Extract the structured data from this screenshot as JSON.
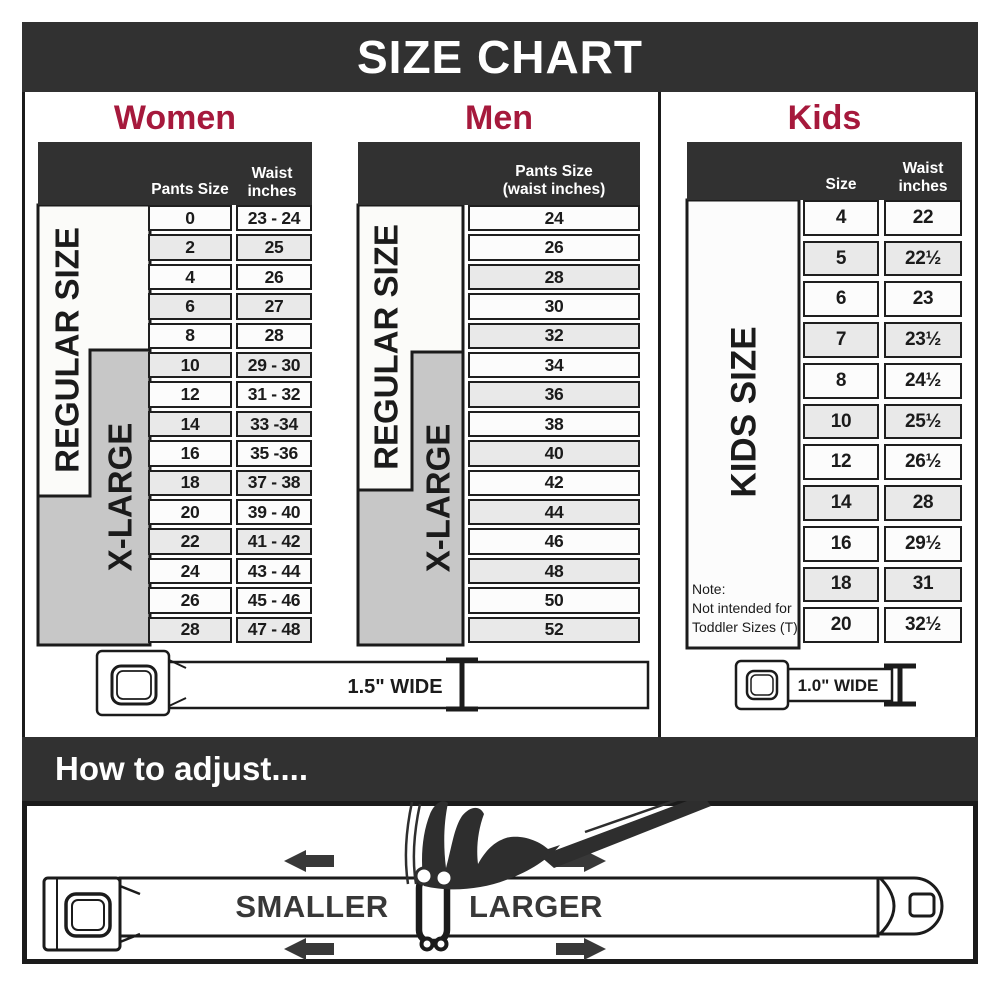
{
  "title": "SIZE CHART",
  "colors": {
    "accent_red": "#A6193C",
    "charcoal": "#313131",
    "row_shade": "#E9E9E9",
    "xlarge_gray": "#C7C7C7"
  },
  "sections": {
    "women": {
      "label": "Women",
      "col1": "Pants Size",
      "col2_line1": "Waist",
      "col2_line2": "inches",
      "regular_label": "REGULAR SIZE",
      "xlarge_label": "X-LARGE",
      "rows": [
        {
          "size": "0",
          "waist": "23 - 24",
          "shaded": false
        },
        {
          "size": "2",
          "waist": "25",
          "shaded": true
        },
        {
          "size": "4",
          "waist": "26",
          "shaded": false
        },
        {
          "size": "6",
          "waist": "27",
          "shaded": true
        },
        {
          "size": "8",
          "waist": "28",
          "shaded": false
        },
        {
          "size": "10",
          "waist": "29 - 30",
          "shaded": true
        },
        {
          "size": "12",
          "waist": "31 - 32",
          "shaded": false
        },
        {
          "size": "14",
          "waist": "33 -34",
          "shaded": true
        },
        {
          "size": "16",
          "waist": "35 -36",
          "shaded": false
        },
        {
          "size": "18",
          "waist": "37 - 38",
          "shaded": true
        },
        {
          "size": "20",
          "waist": "39 - 40",
          "shaded": false
        },
        {
          "size": "22",
          "waist": "41 - 42",
          "shaded": true
        },
        {
          "size": "24",
          "waist": "43 - 44",
          "shaded": false
        },
        {
          "size": "26",
          "waist": "45 - 46",
          "shaded": false
        },
        {
          "size": "28",
          "waist": "47 - 48",
          "shaded": true
        }
      ]
    },
    "men": {
      "label": "Men",
      "col1_line1": "Pants Size",
      "col1_line2": "(waist inches)",
      "regular_label": "REGULAR SIZE",
      "xlarge_label": "X-LARGE",
      "rows": [
        {
          "size": "24",
          "shaded": false
        },
        {
          "size": "26",
          "shaded": false
        },
        {
          "size": "28",
          "shaded": true
        },
        {
          "size": "30",
          "shaded": false
        },
        {
          "size": "32",
          "shaded": true
        },
        {
          "size": "34",
          "shaded": false
        },
        {
          "size": "36",
          "shaded": true
        },
        {
          "size": "38",
          "shaded": false
        },
        {
          "size": "40",
          "shaded": true
        },
        {
          "size": "42",
          "shaded": false
        },
        {
          "size": "44",
          "shaded": true
        },
        {
          "size": "46",
          "shaded": false
        },
        {
          "size": "48",
          "shaded": true
        },
        {
          "size": "50",
          "shaded": false
        },
        {
          "size": "52",
          "shaded": true
        }
      ]
    },
    "kids": {
      "label": "Kids",
      "col1": "Size",
      "col2_line1": "Waist",
      "col2_line2": "inches",
      "side_label": "KIDS SIZE",
      "note_line1": "Note:",
      "note_line2": "Not intended for",
      "note_line3": "Toddler Sizes (T)",
      "rows": [
        {
          "size": "4",
          "waist": "22",
          "shaded": false
        },
        {
          "size": "5",
          "waist": "22½",
          "shaded": true
        },
        {
          "size": "6",
          "waist": "23",
          "shaded": false
        },
        {
          "size": "7",
          "waist": "23½",
          "shaded": true
        },
        {
          "size": "8",
          "waist": "24½",
          "shaded": false
        },
        {
          "size": "10",
          "waist": "25½",
          "shaded": true
        },
        {
          "size": "12",
          "waist": "26½",
          "shaded": false
        },
        {
          "size": "14",
          "waist": "28",
          "shaded": true
        },
        {
          "size": "16",
          "waist": "29½",
          "shaded": false
        },
        {
          "size": "18",
          "waist": "31",
          "shaded": true
        },
        {
          "size": "20",
          "waist": "32½",
          "shaded": false
        }
      ]
    }
  },
  "belts": {
    "adult_width_label": "1.5\" WIDE",
    "kids_width_label": "1.0\" WIDE"
  },
  "how_to_adjust": {
    "title": "How to adjust....",
    "smaller_label": "SMALLER",
    "larger_label": "LARGER"
  },
  "chart_data": [
    {
      "type": "table",
      "title": "Women",
      "columns": [
        "Pants Size",
        "Waist inches"
      ],
      "rows": [
        [
          "0",
          "23 - 24"
        ],
        [
          "2",
          "25"
        ],
        [
          "4",
          "26"
        ],
        [
          "6",
          "27"
        ],
        [
          "8",
          "28"
        ],
        [
          "10",
          "29 - 30"
        ],
        [
          "12",
          "31 - 32"
        ],
        [
          "14",
          "33 -34"
        ],
        [
          "16",
          "35 -36"
        ],
        [
          "18",
          "37 - 38"
        ],
        [
          "20",
          "39 - 40"
        ],
        [
          "22",
          "41 - 42"
        ],
        [
          "24",
          "43 - 44"
        ],
        [
          "26",
          "45 - 46"
        ],
        [
          "28",
          "47 - 48"
        ]
      ],
      "groups": [
        {
          "label": "REGULAR SIZE",
          "sizes": "0-18"
        },
        {
          "label": "X-LARGE",
          "sizes": "10-28"
        }
      ],
      "belt_width": "1.5\" WIDE"
    },
    {
      "type": "table",
      "title": "Men",
      "columns": [
        "Pants Size (waist inches)"
      ],
      "rows": [
        [
          "24"
        ],
        [
          "26"
        ],
        [
          "28"
        ],
        [
          "30"
        ],
        [
          "32"
        ],
        [
          "34"
        ],
        [
          "36"
        ],
        [
          "38"
        ],
        [
          "40"
        ],
        [
          "42"
        ],
        [
          "44"
        ],
        [
          "46"
        ],
        [
          "48"
        ],
        [
          "50"
        ],
        [
          "52"
        ]
      ],
      "groups": [
        {
          "label": "REGULAR SIZE",
          "sizes": "24-42"
        },
        {
          "label": "X-LARGE",
          "sizes": "34-52"
        }
      ],
      "belt_width": "1.5\" WIDE"
    },
    {
      "type": "table",
      "title": "Kids",
      "columns": [
        "Size",
        "Waist inches"
      ],
      "rows": [
        [
          "4",
          "22"
        ],
        [
          "5",
          "22½"
        ],
        [
          "6",
          "23"
        ],
        [
          "7",
          "23½"
        ],
        [
          "8",
          "24½"
        ],
        [
          "10",
          "25½"
        ],
        [
          "12",
          "26½"
        ],
        [
          "14",
          "28"
        ],
        [
          "16",
          "29½"
        ],
        [
          "18",
          "31"
        ],
        [
          "20",
          "32½"
        ]
      ],
      "groups": [
        {
          "label": "KIDS SIZE",
          "sizes": "4-20"
        }
      ],
      "note": "Note: Not intended for Toddler Sizes (T)",
      "belt_width": "1.0\" WIDE"
    }
  ]
}
